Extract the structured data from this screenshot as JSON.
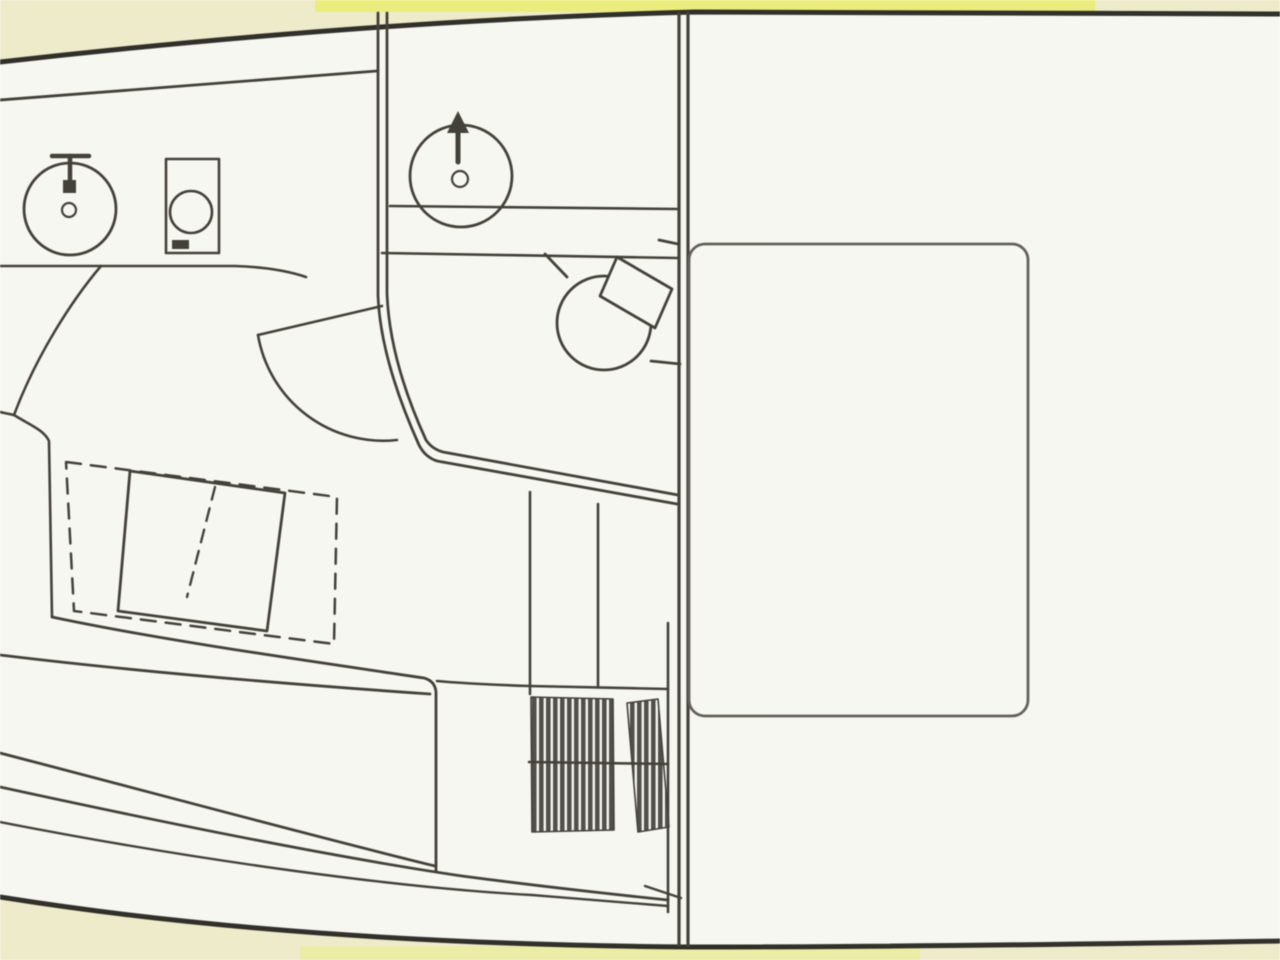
{
  "meta": {
    "title": "Boat interior floor plan — scanned line drawing",
    "drawing_type": "top-view deck / accommodation plan",
    "text_labels": []
  },
  "palette": {
    "page_cream": "#f1eecd",
    "highlight_yellow": "#edf07e",
    "lower_yellow": "#eef0a8",
    "paper_white": "#fbfbf5",
    "ink": "#343129",
    "ink_heavy": "#201f1a",
    "ink_soft": "#57544d",
    "hatch": "#45423d"
  },
  "components": {
    "hull": {
      "label": "hull sheer and bottom outline"
    },
    "side_deck": {
      "label": "inner side-deck line"
    },
    "galley_counter": {
      "label": "forward galley counter edge"
    },
    "galley_sink": {
      "label": "round galley sink with T-faucet and drain"
    },
    "galley_stove": {
      "label": "stove / burner unit"
    },
    "cabin_door": {
      "label": "head door leaf with swing arc"
    },
    "head_bulkhead": {
      "label": "head compartment double-line partition"
    },
    "head_counter": {
      "label": "head vanity counter lines"
    },
    "head_sink": {
      "label": "head wash basin with arrow faucet"
    },
    "toilet": {
      "label": "marine toilet with angled tank"
    },
    "berth_infill": {
      "label": "dashed berth infill outline"
    },
    "dinette_table": {
      "label": "convertible dinette table with dashed fold line"
    },
    "bow_edge": {
      "label": "bow berth walkway edge"
    },
    "settee": {
      "label": "settee berth with hull contour lines"
    },
    "steps": {
      "label": "hatched companionway steps"
    },
    "main_bulkhead": {
      "label": "full-height main bulkhead (double line)"
    },
    "cockpit_module": {
      "label": "cockpit rounded module (engine hatch / seat)"
    }
  }
}
